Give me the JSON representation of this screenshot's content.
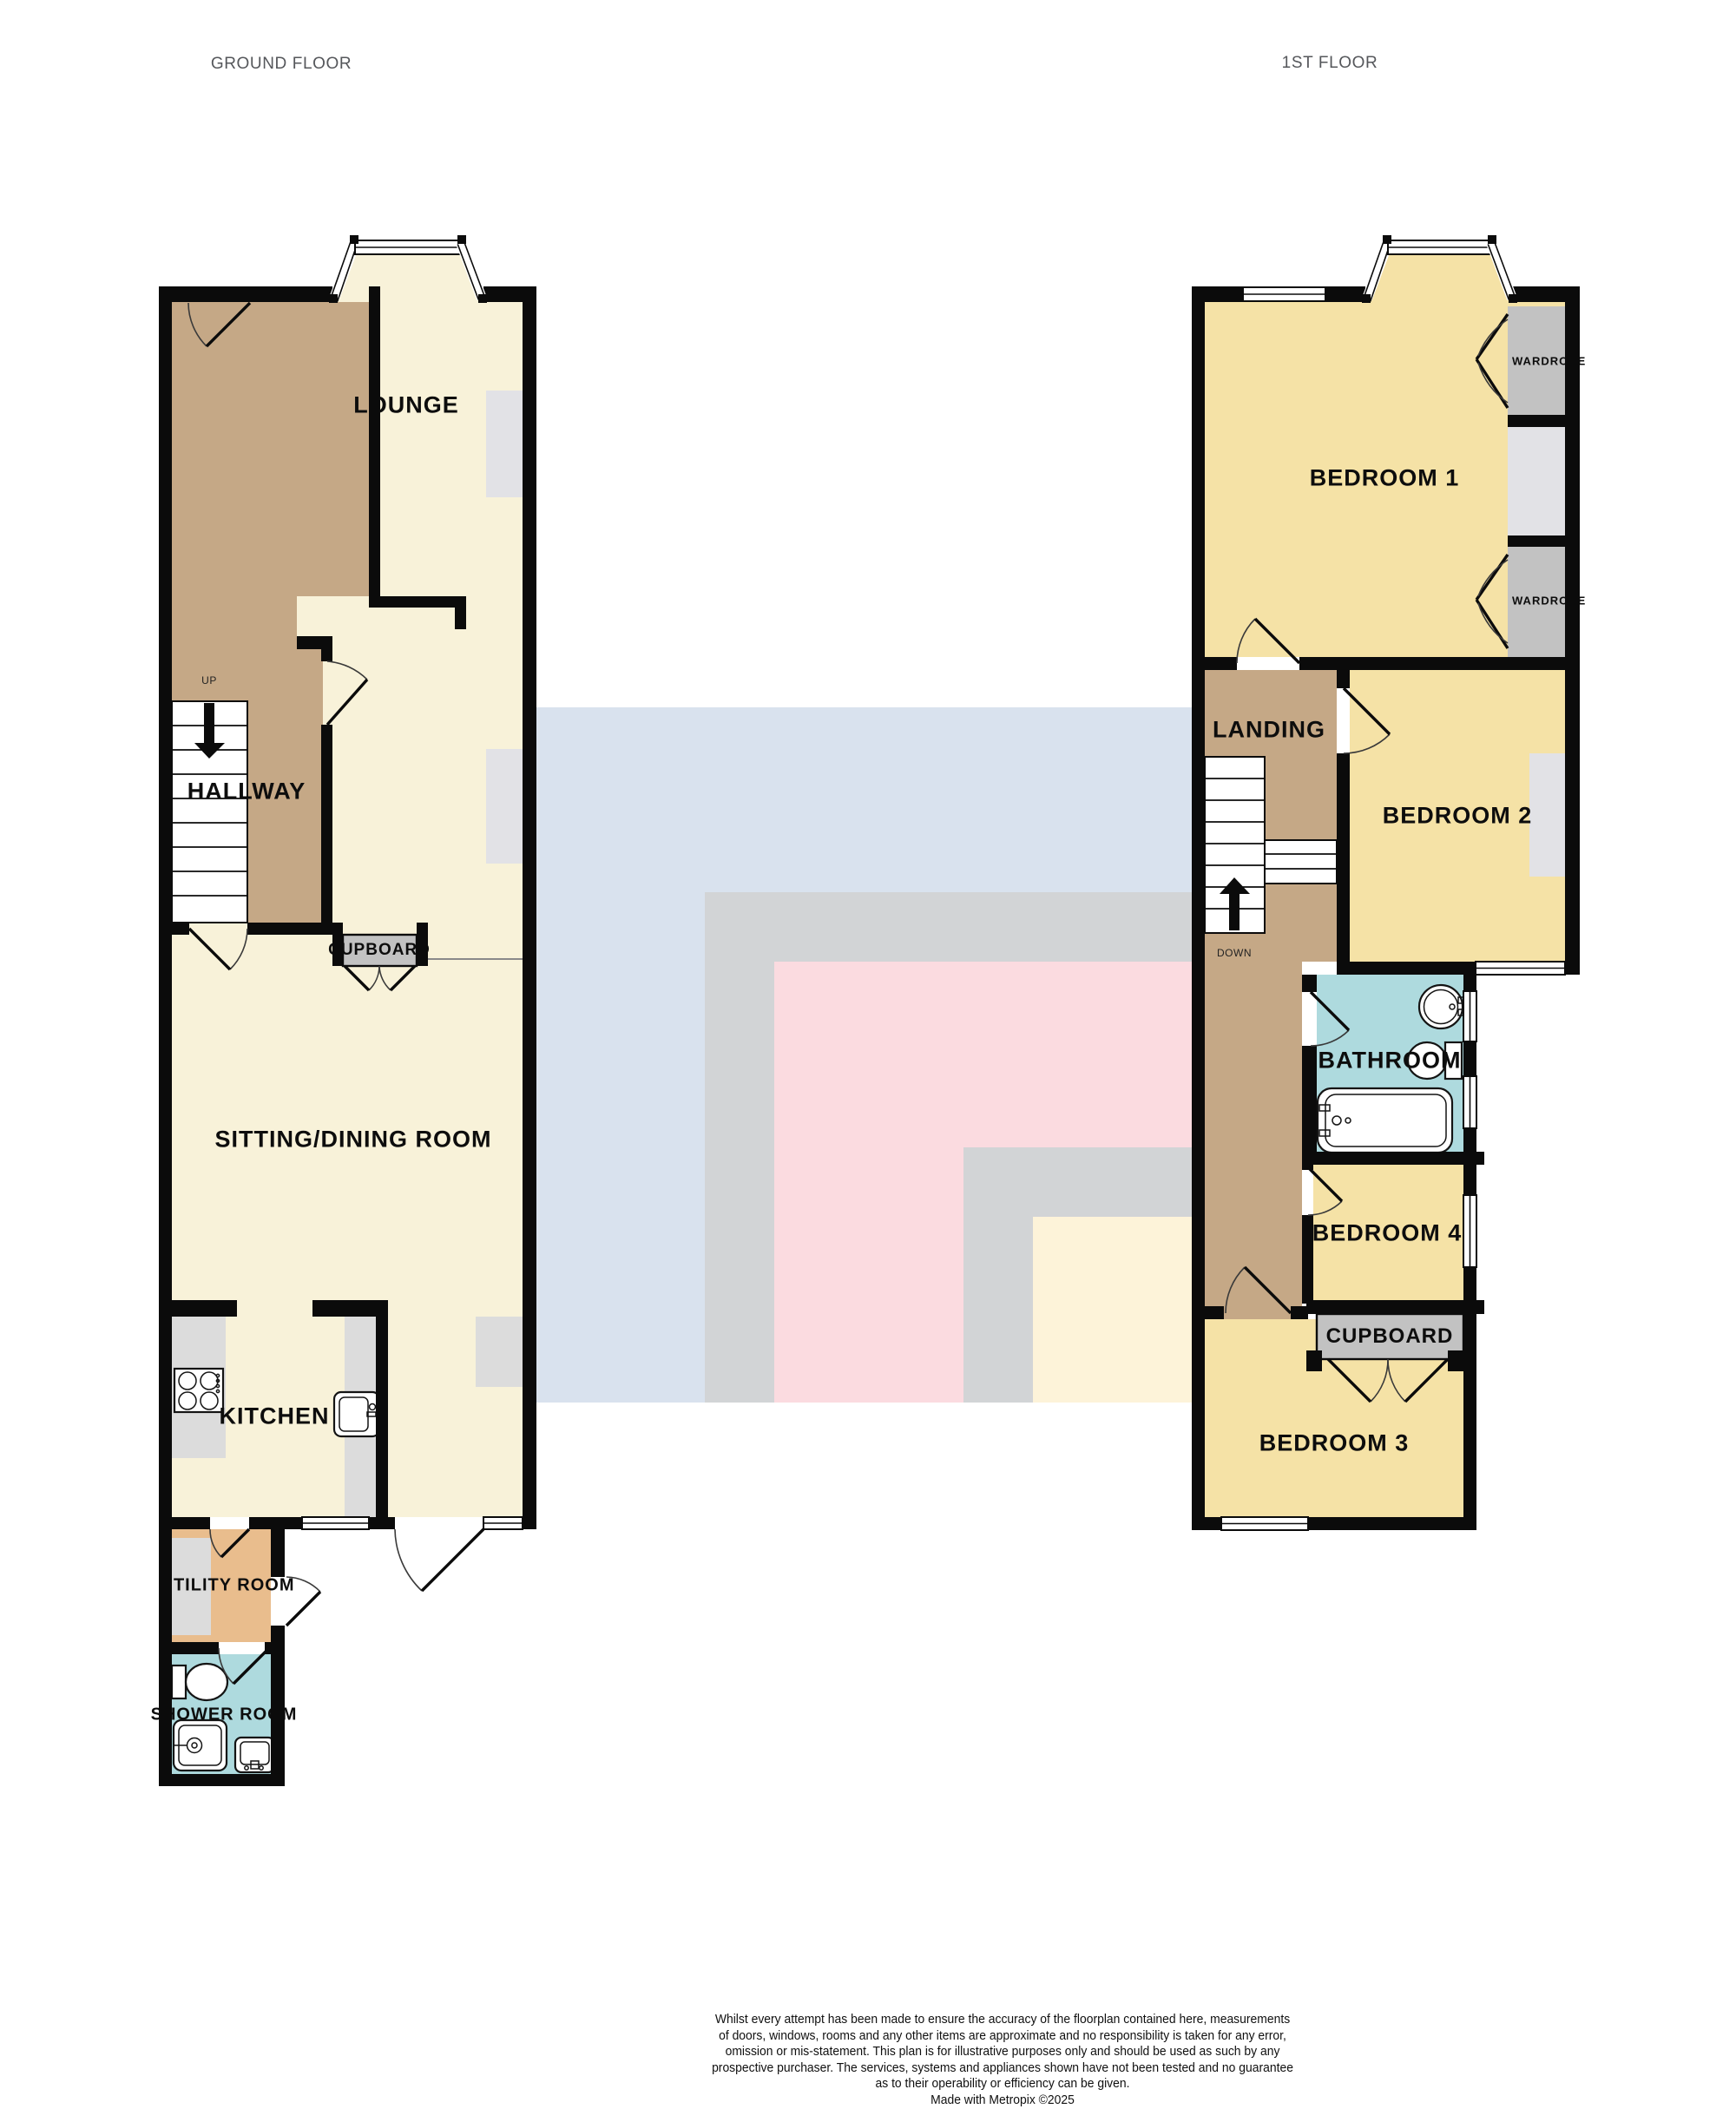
{
  "titles": {
    "ground": "GROUND FLOOR",
    "first": "1ST FLOOR"
  },
  "ground": {
    "lounge": "LOUNGE",
    "hallway": "HALLWAY",
    "up": "UP",
    "cupboard": "CUPBOARD",
    "sitting": "SITTING/DINING ROOM",
    "kitchen": "KITCHEN",
    "utility": "UTILITY ROOM",
    "shower": "SHOWER ROOM"
  },
  "first": {
    "bedroom1": "BEDROOM 1",
    "wardrobe": "WARDROBE",
    "landing": "LANDING",
    "down": "DOWN",
    "bedroom2": "BEDROOM 2",
    "bathroom": "BATHROOM",
    "bedroom4": "BEDROOM 4",
    "cupboard": "CUPBOARD",
    "bedroom3": "BEDROOM 3"
  },
  "footer": {
    "lines": [
      "Whilst every attempt has been made to ensure the accuracy of the floorplan contained here, measurements",
      "of doors, windows, rooms and any other items are approximate and no responsibility is taken for any error,",
      "omission or mis-statement. This plan is for illustrative purposes only and should be used as such by any",
      "prospective purchaser. The services, systems and appliances shown have not been tested and no guarantee",
      "as to their operability or efficiency can be given.",
      "Made with Metropix ©2025"
    ]
  },
  "colors": {
    "wall": "#0b0b0b",
    "cream": "#f8f2d9",
    "brown": "#c5a886",
    "yellow": "#f5e2a6",
    "blue": "#aedade",
    "orange": "#e9bd8d",
    "counter": "#dcdcdc",
    "closet": "#c2c2c2",
    "recess": "#e2e2e6",
    "wm-blue": "#d9e2ee",
    "wm-gray": "#d2d4d6",
    "wm-pink": "#fbdbe0",
    "wm-yellow": "#fdf3d9",
    "title": "#55575b",
    "ink": "#101010"
  }
}
